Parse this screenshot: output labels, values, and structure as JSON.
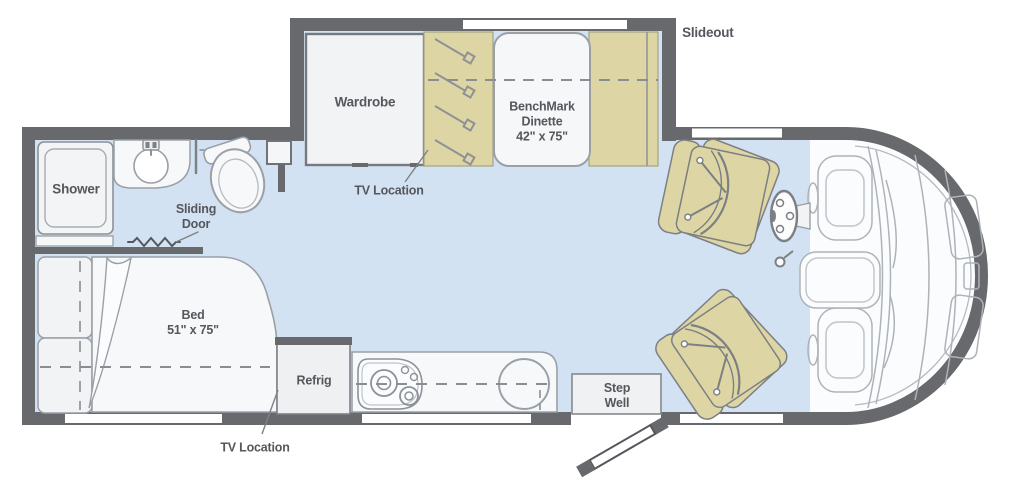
{
  "diagram_type": "rv-floorplan",
  "colors": {
    "wall": "#67696d",
    "floor": "#d3e2f2",
    "furniture_tan": "#ddd6a4",
    "furniture_white": "#f5f6f8",
    "outline_gray": "#9aa0a6",
    "label_text": "#54575c"
  },
  "labels": {
    "slideout": "Slideout",
    "wardrobe": "Wardrobe",
    "dinette": "BenchMark\nDinette\n42\" x 75\"",
    "tv_location_top": "TV Location",
    "shower": "Shower",
    "sliding_door": "Sliding\nDoor",
    "bed": "Bed\n51\" x 75\"",
    "refrig": "Refrig",
    "step_well": "Step\nWell",
    "tv_location_bottom": "TV Location"
  }
}
